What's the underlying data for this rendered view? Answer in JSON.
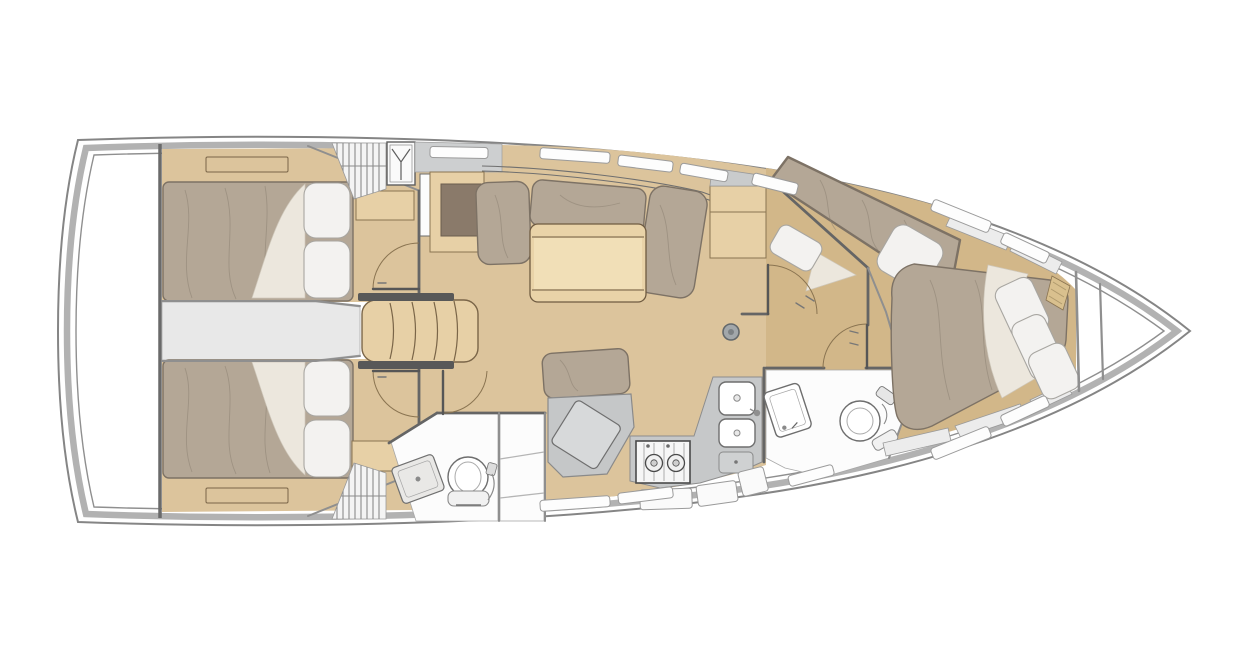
{
  "meta": {
    "diagram_type": "sailboat-interior-floor-plan",
    "view": "top-down",
    "bow_direction": "right",
    "visible_text": "none"
  },
  "colors": {
    "bg": "#ffffff",
    "hull-line": "#858585",
    "deck-band": "#b2b2b2",
    "inner-line": "#8f8f8f",
    "floor-wood": "#dcc49c",
    "floor-wood-2": "#d2b789",
    "wood-furn": "#e7d0a6",
    "wood-line": "#8a7451",
    "table-top": "#e9d3a8",
    "table-center": "#f2e0ba",
    "mattress": "#b4a796",
    "mattress-line": "#7d7265",
    "pillow": "#f3f2f0",
    "pillow-line": "#a8a6a1",
    "sheet": "#ece7dd",
    "dark-panel": "#8a7a6a",
    "wall": "#656565",
    "wall-light": "#8f8f8f",
    "gray-floor": "#e8e8e8",
    "counter": "#c6c8c9",
    "desk": "#c5c7c8",
    "desk-panel": "#d7d9da",
    "fixture-line": "#6e6e6e",
    "shelf-strip": "#ececec",
    "locker": "#fafafa",
    "mast-fill": "#a2a7aa",
    "mast-line": "#63686b",
    "stove-line": "#4a4a4a",
    "headboard": "#d9c08e",
    "white-floor": "#fcfcfc"
  },
  "areas": [
    {
      "id": "swim-platform",
      "kind": "deck",
      "furniture": []
    },
    {
      "id": "aft-cabin-port",
      "kind": "cabin",
      "furniture": [
        "double-berth",
        "pillows",
        "shelf",
        "hinged-door"
      ]
    },
    {
      "id": "aft-cabin-starboard",
      "kind": "cabin",
      "furniture": [
        "double-berth",
        "pillows",
        "shelf",
        "hinged-door"
      ]
    },
    {
      "id": "engine-walkway",
      "kind": "passage",
      "furniture": []
    },
    {
      "id": "companionway",
      "kind": "stairs",
      "furniture": [
        "four-steps",
        "hanging-locker",
        "louvered-vent"
      ]
    },
    {
      "id": "salon",
      "kind": "saloon",
      "furniture": [
        "l-settee",
        "table",
        "cabinet",
        "chart-locker",
        "mast-post"
      ]
    },
    {
      "id": "nav-station",
      "kind": "workspace",
      "furniture": [
        "bench-cushion",
        "chart-desk"
      ]
    },
    {
      "id": "port-head",
      "kind": "bathroom",
      "furniture": [
        "toilet",
        "vanity-sink",
        "shower-stall"
      ]
    },
    {
      "id": "galley",
      "kind": "kitchen",
      "furniture": [
        "two-burner-stove",
        "double-sink",
        "faucet",
        "hatch",
        "lockers"
      ]
    },
    {
      "id": "mid-cabin-starboard",
      "kind": "cabin",
      "furniture": [
        "angled-double-berth",
        "pillows",
        "hinged-door"
      ]
    },
    {
      "id": "forward-head",
      "kind": "bathroom",
      "furniture": [
        "toilet",
        "vanity-sink",
        "shower-fittings",
        "hinged-door"
      ]
    },
    {
      "id": "forward-cabin",
      "kind": "cabin",
      "furniture": [
        "island-berth",
        "pillows",
        "headboard",
        "side-shelves"
      ]
    },
    {
      "id": "bow-locker",
      "kind": "storage",
      "furniture": [
        "bulkheads"
      ]
    }
  ],
  "icons": [
    {
      "name": "hanger-icon",
      "meaning": "hanging wardrobe locker"
    },
    {
      "name": "burner-icon",
      "meaning": "stove burner"
    },
    {
      "name": "drain-icon",
      "meaning": "sink drain"
    }
  ]
}
